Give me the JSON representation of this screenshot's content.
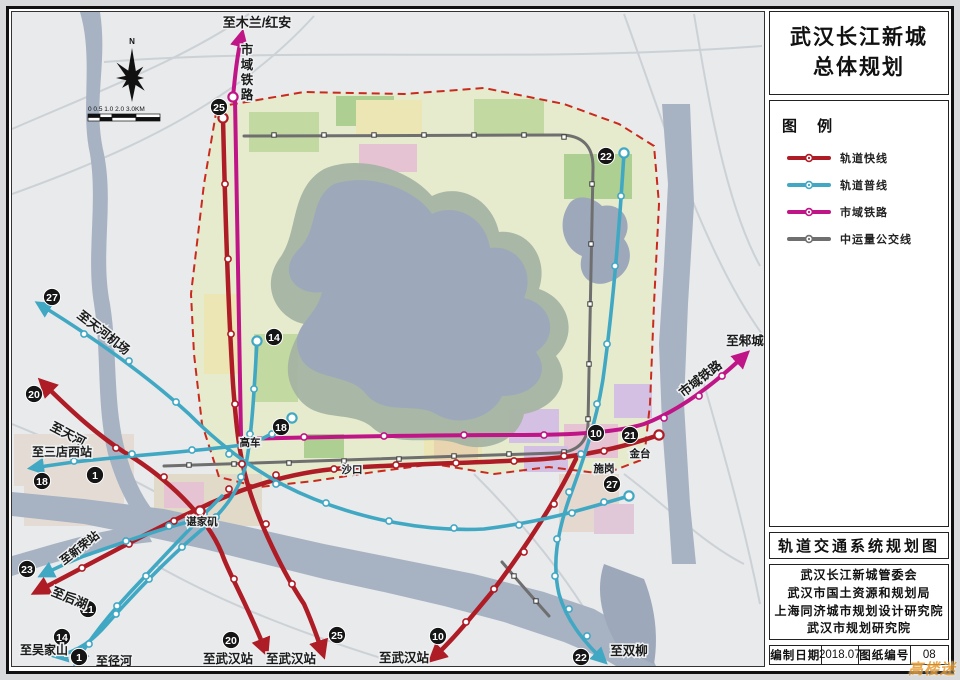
{
  "sheet": {
    "panel": {
      "title": [
        "武汉长江新城",
        "总体规划"
      ],
      "legend_title": "图 例",
      "legend_items": [
        {
          "label": "轨道快线",
          "color": "#ae1c26"
        },
        {
          "label": "轨道普线",
          "color": "#41a8c4"
        },
        {
          "label": "市域铁路",
          "color": "#c01586"
        },
        {
          "label": "中运量公交线",
          "color": "#6f6f6f"
        }
      ],
      "map_title": "轨道交通系统规划图",
      "credits": [
        "武汉长江新城管委会",
        "武汉市国土资源和规划局",
        "上海同济城市规划设计研究院",
        "武汉市规划研究院"
      ],
      "footer": [
        {
          "label": "编制日期",
          "value": "2018.07"
        },
        {
          "label": "图纸编号",
          "value": "08"
        }
      ]
    },
    "map": {
      "north_label": "N",
      "scale_labels": "0 0.5 1.0    2.0     3.0KM",
      "destination_labels": [
        {
          "text": "至木兰/红安",
          "x": 253,
          "y": 23,
          "size": 13,
          "rotate": 0
        },
        {
          "text": "至天河机场",
          "x": 97,
          "y": 332,
          "size": 12.5,
          "rotate": 38
        },
        {
          "text": "至天河",
          "x": 62,
          "y": 434,
          "size": 12.5,
          "rotate": 28
        },
        {
          "text": "至三店西站",
          "x": 58,
          "y": 452,
          "size": 12,
          "rotate": 0
        },
        {
          "text": "至新荣站",
          "x": 78,
          "y": 547,
          "size": 11.5,
          "rotate": -38
        },
        {
          "text": "至后湖",
          "x": 64,
          "y": 598,
          "size": 12.5,
          "rotate": 22
        },
        {
          "text": "至吴家山",
          "x": 40,
          "y": 650,
          "size": 12,
          "rotate": 0
        },
        {
          "text": "至径河",
          "x": 110,
          "y": 661,
          "size": 12,
          "rotate": 0
        },
        {
          "text": "至武汉站",
          "x": 224,
          "y": 659,
          "size": 12.5,
          "rotate": 0
        },
        {
          "text": "至武汉站",
          "x": 287,
          "y": 659,
          "size": 12.5,
          "rotate": 0
        },
        {
          "text": "至武汉站",
          "x": 400,
          "y": 658,
          "size": 12.5,
          "rotate": 0
        },
        {
          "text": "至双柳",
          "x": 625,
          "y": 651,
          "size": 12.5,
          "rotate": 0
        },
        {
          "text": "至邾城",
          "x": 741,
          "y": 341,
          "size": 12.5,
          "rotate": 0
        }
      ],
      "railway_labels": [
        {
          "text": "市域铁路",
          "x": 243,
          "y": 50,
          "size": 12.5,
          "vertical": true
        },
        {
          "text": "市域铁路",
          "x": 699,
          "y": 378,
          "size": 12.5,
          "rotate": -38
        }
      ],
      "place_labels": [
        {
          "text": "高车",
          "x": 246,
          "y": 442
        },
        {
          "text": "沙口",
          "x": 348,
          "y": 469
        },
        {
          "text": "金台",
          "x": 636,
          "y": 453
        },
        {
          "text": "施岗",
          "x": 600,
          "y": 468
        },
        {
          "text": "谌家矶",
          "x": 198,
          "y": 521
        }
      ],
      "line_badges": [
        {
          "num": "25",
          "x": 215,
          "y": 103
        },
        {
          "num": "22",
          "x": 602,
          "y": 152
        },
        {
          "num": "14",
          "x": 270,
          "y": 333
        },
        {
          "num": "27",
          "x": 48,
          "y": 293
        },
        {
          "num": "20",
          "x": 30,
          "y": 390
        },
        {
          "num": "18",
          "x": 277,
          "y": 423
        },
        {
          "num": "1",
          "x": 91,
          "y": 471
        },
        {
          "num": "18",
          "x": 38,
          "y": 477
        },
        {
          "num": "23",
          "x": 23,
          "y": 565
        },
        {
          "num": "21",
          "x": 84,
          "y": 605
        },
        {
          "num": "14",
          "x": 58,
          "y": 633
        },
        {
          "num": "1",
          "x": 75,
          "y": 653
        },
        {
          "num": "20",
          "x": 227,
          "y": 636
        },
        {
          "num": "25",
          "x": 333,
          "y": 631
        },
        {
          "num": "10",
          "x": 434,
          "y": 632
        },
        {
          "num": "10",
          "x": 592,
          "y": 429
        },
        {
          "num": "21",
          "x": 626,
          "y": 431
        },
        {
          "num": "27",
          "x": 608,
          "y": 480
        },
        {
          "num": "22",
          "x": 577,
          "y": 653
        }
      ]
    },
    "watermark": "高楼迷"
  }
}
